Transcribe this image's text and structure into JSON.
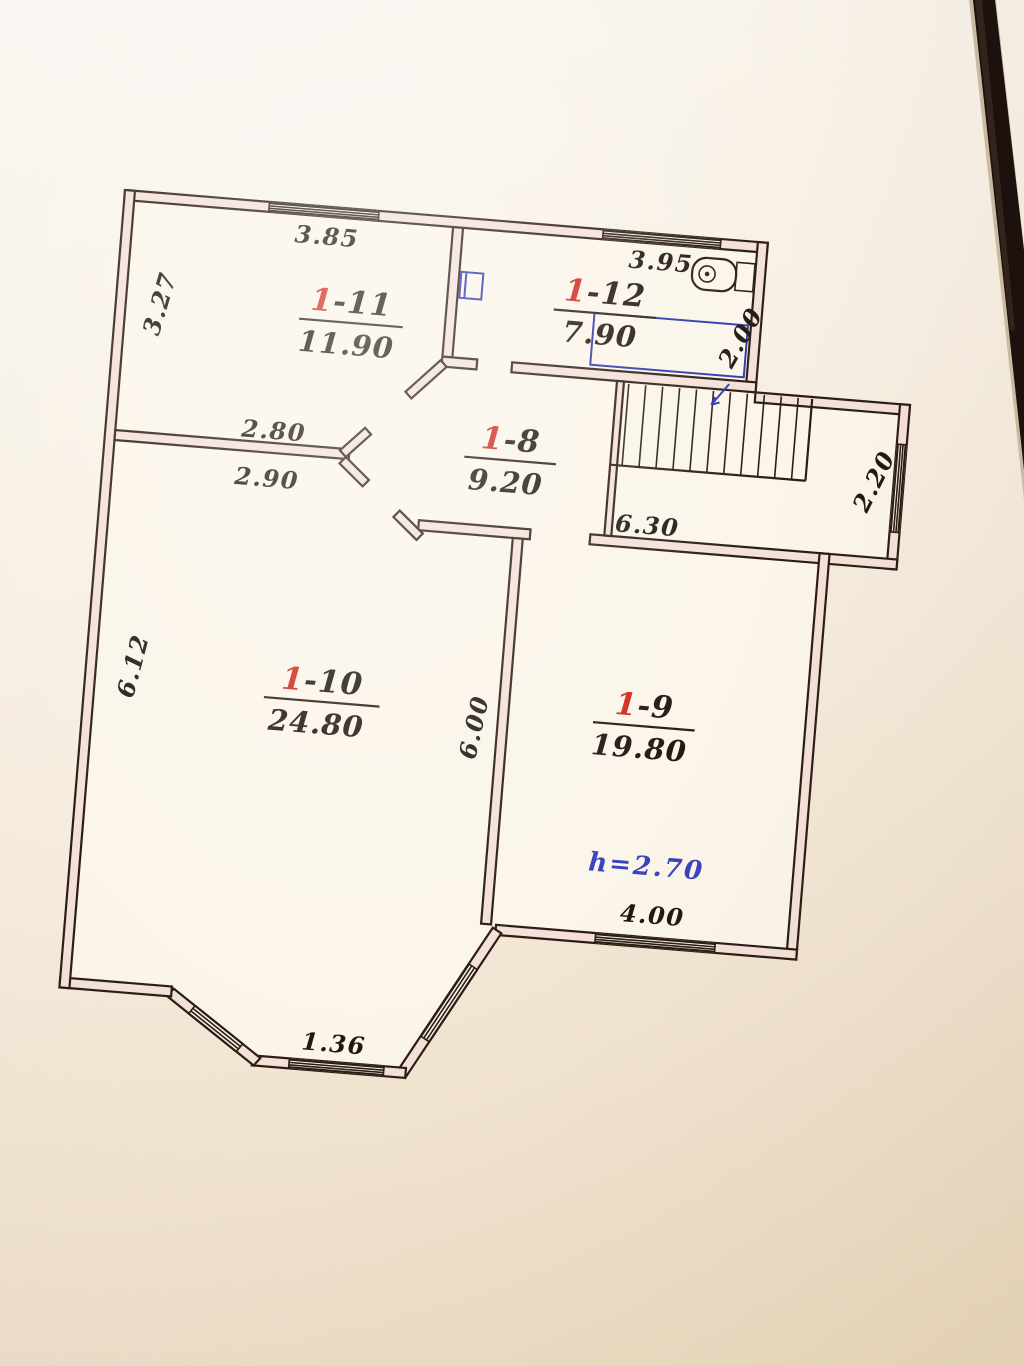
{
  "document": {
    "kind": "hand-drawn floor plan photo",
    "floor_note": "first floor apartment plan"
  },
  "rooms": [
    {
      "num_prefix": "1",
      "num_suffix": "-11",
      "area": "11.90"
    },
    {
      "num_prefix": "1",
      "num_suffix": "-12",
      "area": "7.90"
    },
    {
      "num_prefix": "1",
      "num_suffix": "-8",
      "area": "9.20"
    },
    {
      "num_prefix": "1",
      "num_suffix": "-10",
      "area": "24.80"
    },
    {
      "num_prefix": "1",
      "num_suffix": "-9",
      "area": "19.80"
    }
  ],
  "dims": {
    "room11_width": "3.85",
    "room12_width": "3.95",
    "room11_depth": "3.27",
    "wall_above": "2.80",
    "wall_below": "2.90",
    "hall_span": "6.30",
    "room10_depth": "6.12",
    "partition_depth": "6.00",
    "stair_side": "2.20",
    "room12_depth": "2.00",
    "room9_window": "4.00",
    "bay_window": "1.36",
    "ceiling_height": "h=2.70"
  },
  "colors": {
    "ink": "#2b1d13",
    "red_accent": "#cf2b1d",
    "blue_pen": "#3a43c0",
    "wall_fill": "#f4e1d9",
    "paper": "#f6eee0"
  },
  "icons": {
    "boiler": "water-heater",
    "tub": "bathtub",
    "sink": "wash-basin"
  }
}
